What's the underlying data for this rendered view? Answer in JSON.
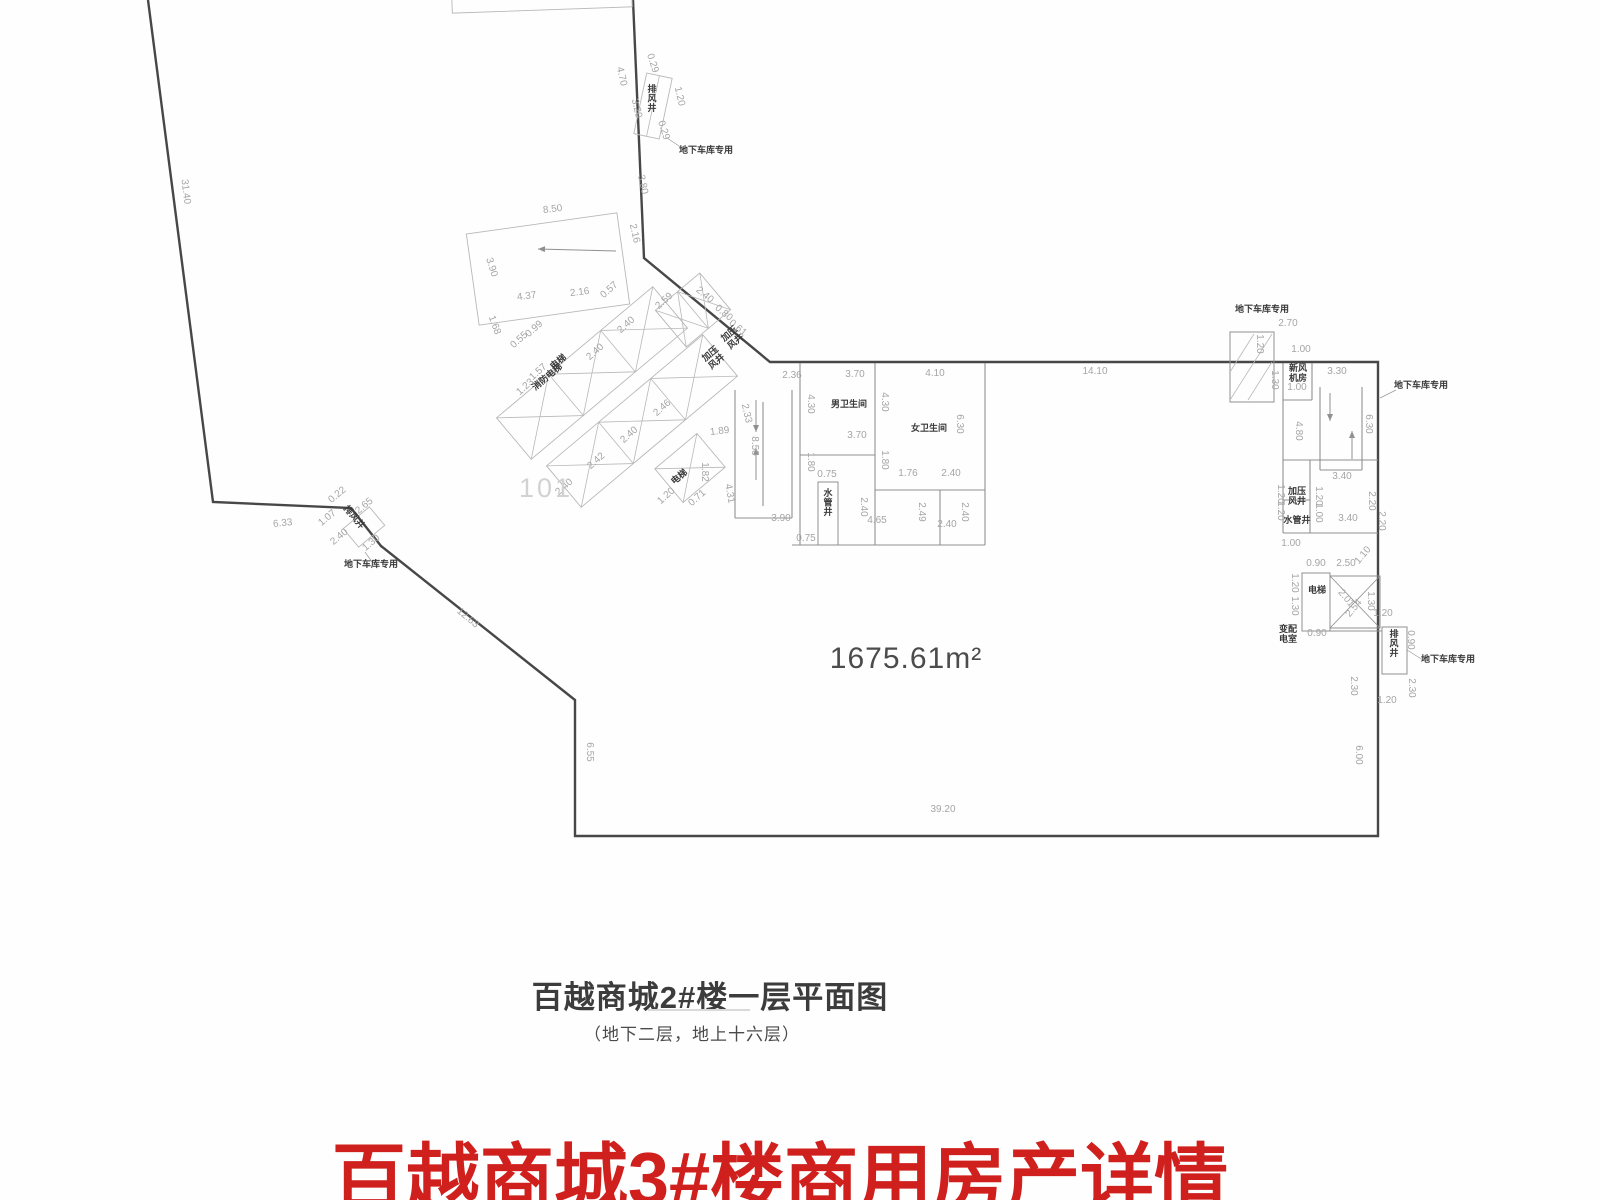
{
  "caption": {
    "title": "百越商城2#楼一层平面图",
    "subtitle": "（地下二层，地上十六层）"
  },
  "heading": {
    "text": "百越商城3#楼商用房产详情",
    "color": "#d0201e"
  },
  "plan": {
    "room_number": "101",
    "area_label": "1675.61m²",
    "colors": {
      "outline": "#474747",
      "wall": "#909090",
      "light": "#b8b8b8",
      "dim_text": "#a5a5a5",
      "dark_text": "#3a3a3a",
      "leader": "#9a9a9a"
    },
    "outline_points": "148,0 213,502 351,508 381,546 575,700 575,836 1378,836 1378,362 770,362 644,258 633,0",
    "walls": [
      [
        735,
        390,
        735,
        518
      ],
      [
        735,
        518,
        792,
        518
      ],
      [
        792,
        390,
        792,
        518
      ],
      [
        763,
        402,
        763,
        506
      ],
      [
        800,
        363,
        800,
        545
      ],
      [
        875,
        363,
        875,
        545
      ],
      [
        985,
        363,
        985,
        545
      ],
      [
        800,
        455,
        875,
        455
      ],
      [
        875,
        490,
        985,
        490
      ],
      [
        792,
        545,
        985,
        545
      ],
      [
        940,
        490,
        940,
        545
      ],
      [
        1283,
        363,
        1283,
        533
      ],
      [
        1283,
        460,
        1378,
        460
      ],
      [
        1283,
        533,
        1378,
        533
      ],
      [
        1310,
        460,
        1310,
        533
      ],
      [
        1283,
        500,
        1310,
        500
      ],
      [
        1312,
        363,
        1312,
        400
      ],
      [
        1283,
        400,
        1312,
        400
      ],
      [
        1320,
        387,
        1320,
        470
      ],
      [
        1362,
        387,
        1362,
        470
      ],
      [
        1320,
        470,
        1362,
        470
      ],
      [
        1302,
        631,
        1382,
        631
      ]
    ],
    "rects": [
      [
        1302,
        573,
        28,
        58
      ],
      [
        1382,
        627,
        25,
        47
      ],
      [
        818,
        482,
        20,
        63
      ],
      [
        1230,
        332,
        44,
        70
      ]
    ],
    "xboxes": [
      [
        1330,
        576,
        50,
        52
      ]
    ],
    "hatch_lines": [
      [
        1230,
        400,
        1272,
        334
      ],
      [
        1230,
        372,
        1254,
        334
      ],
      [
        1248,
        400,
        1272,
        362
      ]
    ],
    "light_rects": [
      {
        "cx": 548,
        "cy": 269,
        "w": 152,
        "h": 92,
        "rot": -8,
        "cells": 1,
        "x": false
      },
      {
        "cx": 653,
        "cy": 106,
        "w": 26,
        "h": 62,
        "rot": 12,
        "cells": 2,
        "x": false
      },
      {
        "cx": 364,
        "cy": 527,
        "w": 34,
        "h": 24,
        "rot": -40,
        "cells": 1,
        "x": false
      },
      {
        "cx": 592,
        "cy": 373,
        "w": 204,
        "h": 54,
        "rot": -40,
        "cells": 3,
        "x": true
      },
      {
        "cx": 642,
        "cy": 421,
        "w": 204,
        "h": 54,
        "rot": -40,
        "cells": 3,
        "x": true
      },
      {
        "cx": 693,
        "cy": 310,
        "w": 58,
        "h": 48,
        "rot": -40,
        "cells": 2,
        "x": true
      },
      {
        "cx": 690,
        "cy": 468,
        "w": 55,
        "h": 44,
        "rot": -40,
        "cells": 1,
        "x": true
      },
      {
        "cx": 542,
        "cy": 2,
        "w": 180,
        "h": 16,
        "rot": -2,
        "cells": 1,
        "x": false
      }
    ],
    "arrows": [
      [
        616,
        251,
        538,
        249
      ],
      [
        756,
        400,
        756,
        432
      ],
      [
        756,
        480,
        756,
        448
      ],
      [
        1330,
        393,
        1330,
        421
      ],
      [
        1352,
        459,
        1352,
        431
      ]
    ],
    "leaders": [
      [
        667,
        138,
        682,
        148
      ],
      [
        1380,
        398,
        1396,
        390
      ],
      [
        1407,
        650,
        1423,
        660
      ],
      [
        365,
        552,
        372,
        562
      ]
    ],
    "dims": [
      [
        "31.40",
        183,
        192,
        83
      ],
      [
        "4.70",
        619,
        77,
        77
      ],
      [
        "0.29",
        650,
        64,
        72
      ],
      [
        "3.20",
        634,
        109,
        77
      ],
      [
        "1.20",
        677,
        97,
        77
      ],
      [
        "0.29",
        661,
        131,
        72
      ],
      [
        "3.80",
        640,
        185,
        78
      ],
      [
        "2.16",
        632,
        234,
        77
      ],
      [
        "8.50",
        553,
        212,
        -7
      ],
      [
        "3.90",
        489,
        268,
        73
      ],
      [
        "4.37",
        527,
        299,
        -7
      ],
      [
        "2.16",
        580,
        295,
        -7
      ],
      [
        "0.57",
        611,
        292,
        -42
      ],
      [
        "2.59",
        666,
        303,
        -42
      ],
      [
        "2.40",
        703,
        297,
        40
      ],
      [
        "0.80",
        722,
        315,
        40
      ],
      [
        "0.61",
        736,
        330,
        40
      ],
      [
        "1.68",
        492,
        326,
        70
      ],
      [
        "0.99",
        536,
        331,
        -42
      ],
      [
        "0.55",
        521,
        342,
        -42
      ],
      [
        "1.57",
        540,
        374,
        -42
      ],
      [
        "1.23",
        527,
        389,
        -42
      ],
      [
        "2.40",
        628,
        327,
        -42
      ],
      [
        "2.40",
        597,
        354,
        -42
      ],
      [
        "2.46",
        664,
        410,
        -42
      ],
      [
        "2.40",
        631,
        437,
        -42
      ],
      [
        "2.42",
        598,
        463,
        -42
      ],
      [
        "2.40",
        566,
        489,
        -42
      ],
      [
        "1.89",
        720,
        434,
        -7
      ],
      [
        "1.82",
        702,
        472,
        90
      ],
      [
        "1.20",
        668,
        498,
        -42
      ],
      [
        "0.71",
        699,
        500,
        -42
      ],
      [
        "4.31",
        727,
        494,
        80
      ],
      [
        "2.33",
        744,
        414,
        77
      ],
      [
        "8.50",
        752,
        446,
        90
      ],
      [
        "2.36",
        792,
        378,
        0
      ],
      [
        "3.70",
        855,
        377,
        0
      ],
      [
        "4.10",
        935,
        376,
        0
      ],
      [
        "14.10",
        1095,
        374,
        0
      ],
      [
        "4.30",
        808,
        404,
        90
      ],
      [
        "4.30",
        882,
        402,
        90
      ],
      [
        "6.30",
        957,
        424,
        90
      ],
      [
        "3.70",
        857,
        438,
        0
      ],
      [
        "1.80",
        808,
        462,
        90
      ],
      [
        "1.80",
        882,
        460,
        90
      ],
      [
        "0.75",
        827,
        477,
        0
      ],
      [
        "1.76",
        908,
        476,
        0
      ],
      [
        "2.40",
        951,
        476,
        0
      ],
      [
        "2.40",
        861,
        507,
        90
      ],
      [
        "2.49",
        919,
        512,
        90
      ],
      [
        "2.40",
        962,
        512,
        90
      ],
      [
        "4.65",
        877,
        523,
        0
      ],
      [
        "2.40",
        947,
        527,
        0
      ],
      [
        "3.90",
        781,
        521,
        0
      ],
      [
        "0.75",
        806,
        541,
        0
      ],
      [
        "2.70",
        1288,
        326,
        0
      ],
      [
        "1.20",
        1257,
        344,
        90
      ],
      [
        "1.00",
        1301,
        352,
        0
      ],
      [
        "1.30",
        1272,
        380,
        90
      ],
      [
        "1.00",
        1297,
        390,
        0
      ],
      [
        "3.30",
        1337,
        374,
        0
      ],
      [
        "4.80",
        1296,
        431,
        90
      ],
      [
        "6.30",
        1366,
        424,
        90
      ],
      [
        "3.40",
        1342,
        479,
        0
      ],
      [
        "1.20",
        1278,
        494,
        90
      ],
      [
        "1.20",
        1278,
        511,
        90
      ],
      [
        "1.20",
        1316,
        496,
        90
      ],
      [
        "1.00",
        1316,
        513,
        90
      ],
      [
        "2.20",
        1369,
        501,
        90
      ],
      [
        "3.40",
        1348,
        521,
        0
      ],
      [
        "2.20",
        1379,
        521,
        90
      ],
      [
        "1.00",
        1291,
        546,
        0
      ],
      [
        "0.90",
        1316,
        566,
        0
      ],
      [
        "2.50",
        1346,
        566,
        0
      ],
      [
        "1.10",
        1365,
        557,
        -50
      ],
      [
        "1.20",
        1292,
        583,
        90
      ],
      [
        "1.30",
        1292,
        606,
        90
      ],
      [
        "2.01",
        1344,
        600,
        50
      ],
      [
        "2.54",
        1356,
        610,
        -50
      ],
      [
        "1.30",
        1368,
        601,
        90
      ],
      [
        "0.90",
        1317,
        636,
        0
      ],
      [
        "1.20",
        1383,
        616,
        0
      ],
      [
        "0.90",
        1408,
        640,
        90
      ],
      [
        "2.30",
        1351,
        686,
        90
      ],
      [
        "2.30",
        1409,
        688,
        90
      ],
      [
        "1.20",
        1387,
        703,
        0
      ],
      [
        "6.00",
        1356,
        755,
        90
      ],
      [
        "39.20",
        943,
        812,
        0
      ],
      [
        "6.55",
        587,
        752,
        90
      ],
      [
        "6.33",
        283,
        526,
        -6
      ],
      [
        "0.22",
        339,
        497,
        -40
      ],
      [
        "2.65",
        366,
        508,
        -40
      ],
      [
        "1.07",
        329,
        520,
        -40
      ],
      [
        "2.40",
        341,
        539,
        -40
      ],
      [
        "1.30",
        373,
        545,
        -40
      ],
      [
        "12.63",
        466,
        620,
        40
      ]
    ],
    "dark_labels": [
      [
        "排风井",
        652,
        92,
        "v"
      ],
      [
        "地下车库专用",
        706,
        153,
        0
      ],
      [
        "电梯",
        560,
        364,
        -40
      ],
      [
        "消防电梯",
        549,
        379,
        -40
      ],
      [
        "加压|风井",
        731,
        336,
        -40
      ],
      [
        "加压|风井",
        712,
        356,
        -40
      ],
      [
        "电梯",
        681,
        479,
        -40
      ],
      [
        "男卫生间",
        849,
        407,
        0
      ],
      [
        "女卫生间",
        929,
        431,
        0
      ],
      [
        "水管井",
        828,
        496,
        "v"
      ],
      [
        "排风井",
        352,
        519,
        50
      ],
      [
        "地下车库专用",
        371,
        567,
        0
      ],
      [
        "地下车库专用",
        1262,
        312,
        0
      ],
      [
        "新风|机房",
        1298,
        371,
        0
      ],
      [
        "地下车库专用",
        1421,
        388,
        0
      ],
      [
        "加压|风井",
        1297,
        494,
        0
      ],
      [
        "水管井",
        1297,
        523,
        0
      ],
      [
        "电梯",
        1317,
        593,
        0
      ],
      [
        "变配|电室",
        1288,
        632,
        0
      ],
      [
        "排风井",
        1394,
        637,
        "v"
      ],
      [
        "地下车库专用",
        1448,
        662,
        0
      ]
    ],
    "big_labels": [
      [
        "101",
        546,
        497,
        27,
        "#d2d2d2",
        3
      ],
      [
        "1675.61m²",
        906,
        668,
        30,
        "#4c4c4c",
        1
      ]
    ]
  }
}
